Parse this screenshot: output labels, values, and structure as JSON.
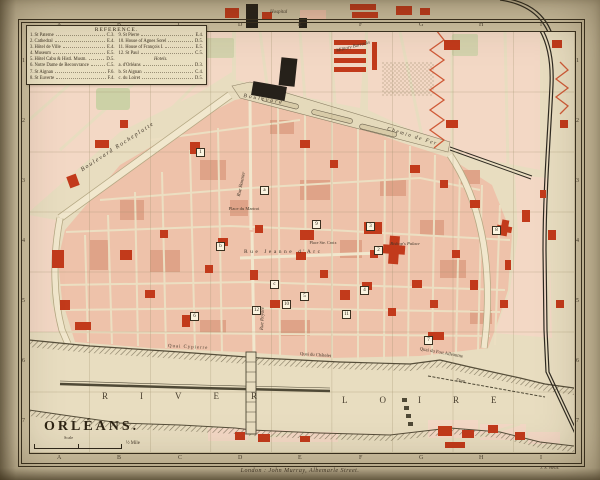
{
  "map": {
    "title": "ORLÉANS.",
    "scale_label": "Scale",
    "scale_value": "½ Mile",
    "imprint": "London : John Murray, Albemarle Street.",
    "engraver": "J. S. Wells.",
    "grid": {
      "columns": [
        "A",
        "B",
        "C",
        "D",
        "E",
        "F",
        "G",
        "H",
        "I"
      ],
      "rows": [
        "1",
        "2",
        "3",
        "4",
        "5",
        "6",
        "7"
      ]
    },
    "legend": {
      "title": "REFERENCE.",
      "left": [
        {
          "n": "1.",
          "name": "St Paterne",
          "ref": "C.3."
        },
        {
          "n": "2.",
          "name": "Cathedral",
          "ref": "E.4."
        },
        {
          "n": "3.",
          "name": "Hôtel de Ville",
          "ref": "E.4."
        },
        {
          "n": "4.",
          "name": "Museum",
          "ref": "E.5."
        },
        {
          "n": "5.",
          "name": "Hôtel Cabu & Histl. Musm.",
          "ref": "D.5."
        },
        {
          "n": "6.",
          "name": "Notre Dame de Recouvrance",
          "ref": "C.5."
        },
        {
          "n": "7.",
          "name": "St Aignan",
          "ref": "F.6."
        },
        {
          "n": "8.",
          "name": "St Euverte",
          "ref": "F.4."
        }
      ],
      "right": [
        {
          "n": "9.",
          "name": "St Pierre",
          "ref": "E.4."
        },
        {
          "n": "10.",
          "name": "House of Agnes Sorel",
          "ref": "D.5."
        },
        {
          "n": "11.",
          "name": "House of François I.",
          "ref": "E.5."
        },
        {
          "n": "12.",
          "name": "St Paul",
          "ref": "C.5."
        }
      ],
      "hotels_title": "Hotels.",
      "hotels": [
        {
          "n": "a.",
          "name": "d'Orléans",
          "ref": "D.3."
        },
        {
          "n": "b.",
          "name": "St Aignan",
          "ref": "C.4."
        },
        {
          "n": "c.",
          "name": "du Loiret",
          "ref": "D.5."
        }
      ]
    },
    "labels": {
      "hospital": "Hospital",
      "military_barracks": "Military Barracks",
      "boulevard_rocheplatte": "Boulevard Rocheplatte",
      "boulevard": "Boulevard",
      "chemin_de_fer": "Chemin de Fer",
      "rue_bannier": "Rue Bannier",
      "rue_royale": "Rue Royale",
      "place_du_martroi": "Place du Martroi",
      "rue_jeanne_darc": "Rue Jeanne d'Arc",
      "place_ste_croix": "Place Ste. Croix",
      "bishops_palace": "Bishop's Palace",
      "quai_cypierre": "Quai Cypierre",
      "quai_du_chatelet": "Quai du Châtelet",
      "quai_fort_alleaume": "Quai du Fort Alleaume",
      "dam": "Dam",
      "river": "RIVER",
      "loire": "LOIRE"
    },
    "markers": [
      "1",
      "2",
      "3",
      "4",
      "5",
      "6",
      "7",
      "8",
      "9",
      "10",
      "11",
      "12",
      "a",
      "b",
      "c"
    ],
    "colors": {
      "building_red": "#c23a1b",
      "block_pink": "#eec2aa",
      "paper": "#e8ddc0",
      "ink": "#39301f"
    }
  }
}
